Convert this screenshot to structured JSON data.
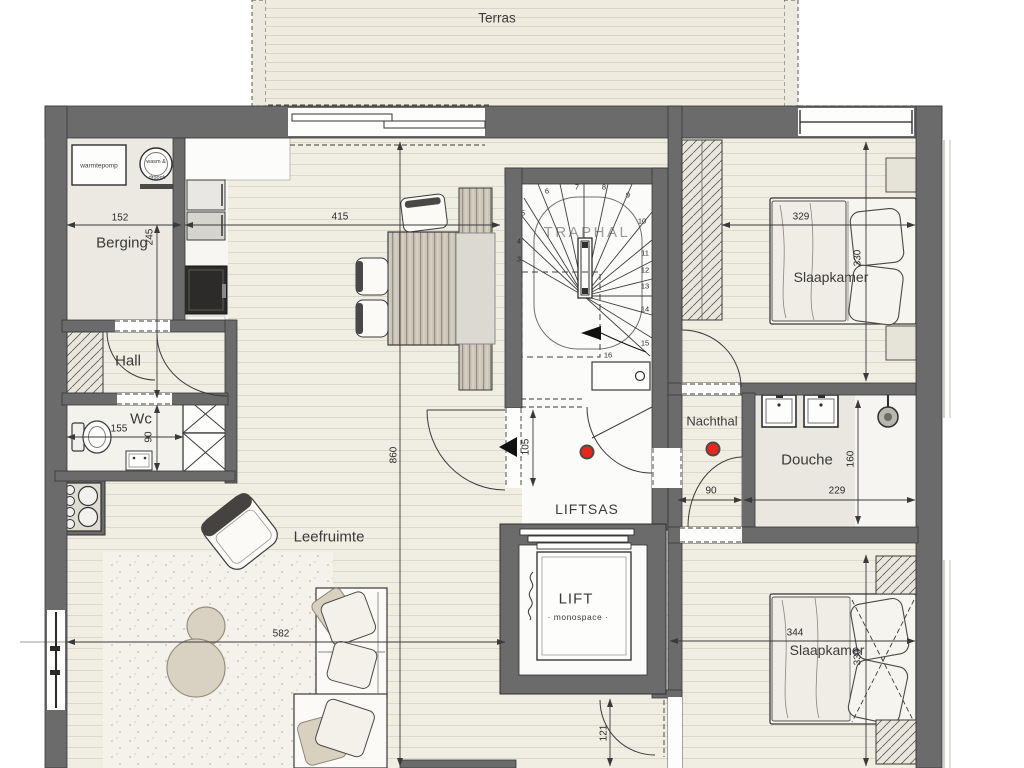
{
  "floorplan": {
    "rooms": {
      "terras": "Terras",
      "berging": "Berging",
      "hall": "Hall",
      "wc": "Wc",
      "leefruimte": "Leefruimte",
      "traphal": "TRAPHAL",
      "liftsas": "LIFTSAS",
      "lift": "LIFT",
      "lift_type": "monospace",
      "nachthal": "Nachthal",
      "douche": "Douche",
      "slaapkamer_1": "Slaapkamer",
      "slaapkamer_2": "Slaapkamer"
    },
    "fixtures": {
      "heat_pump": "warmtepomp",
      "washer_dryer_top": "wasm &",
      "washer_dryer_bottom": "droogk"
    },
    "dimensions_cm": {
      "berging_width": "152",
      "berging_hall_height": "245",
      "kitchen_width": "415",
      "living_height": "860",
      "living_width": "582",
      "wc_width": "155",
      "wc_height": "90",
      "liftsas_door": "105",
      "nachthal_width": "90",
      "douche_width": "229",
      "douche_height": "160",
      "bedroom1_width": "329",
      "bedroom1_height": "330",
      "bedroom2_width": "344",
      "bedroom2_height": "330",
      "bedroom2_door": "121"
    },
    "stair_steps": [
      "3",
      "4",
      "5",
      "6",
      "7",
      "8",
      "9",
      "10",
      "11",
      "12",
      "13",
      "14",
      "15",
      "16"
    ],
    "colors": {
      "wall": "#6b6b6b",
      "smoke_detector_red": "#e8261b"
    }
  }
}
